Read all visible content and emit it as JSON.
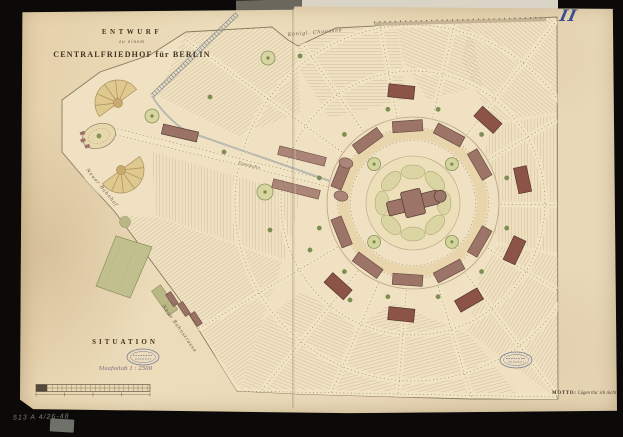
{
  "document": {
    "plate_number": "II",
    "title": {
      "line1": "ENTWURF",
      "line2": "zu einem",
      "line3": "CENTRALFRIEDHOF für BERLIN"
    },
    "section_label": "SITUATION",
    "scale_note": "Maafsstab 1 : 2500",
    "motto": {
      "label": "MOTTO:",
      "text": "Lügen thu' ich nicht"
    },
    "archive_reference": "513 A 4/26-48"
  },
  "map": {
    "street_labels": {
      "north_road": "Königl. Chaussee",
      "west_road": "Neuer Bahnhof",
      "southwest_road": "Neue Bahnstrasse",
      "railway": "Eisenbahn"
    },
    "features": [
      "central-chapel-rotunda",
      "radial-burial-fields",
      "tree-lined-avenues",
      "entrance-forecourt-with-fans",
      "railway-track",
      "nursery-garden",
      "archive-stamps",
      "scale-bar"
    ]
  },
  "colors": {
    "mount": "#0c0a08",
    "paper": "#e9d6b2",
    "plan_field": "#efe1c1",
    "hatch": "#b29a77",
    "building": "#9d7568",
    "building_dark": "#8c5347",
    "garden": "#c1bf8d",
    "lawn": "#dbd5a4",
    "tree": "#7d9052",
    "fan": "#dfc98f",
    "ink": "#3f3222",
    "stamp_ink": "#777b99",
    "plate_ink": "#3a4f8e"
  }
}
